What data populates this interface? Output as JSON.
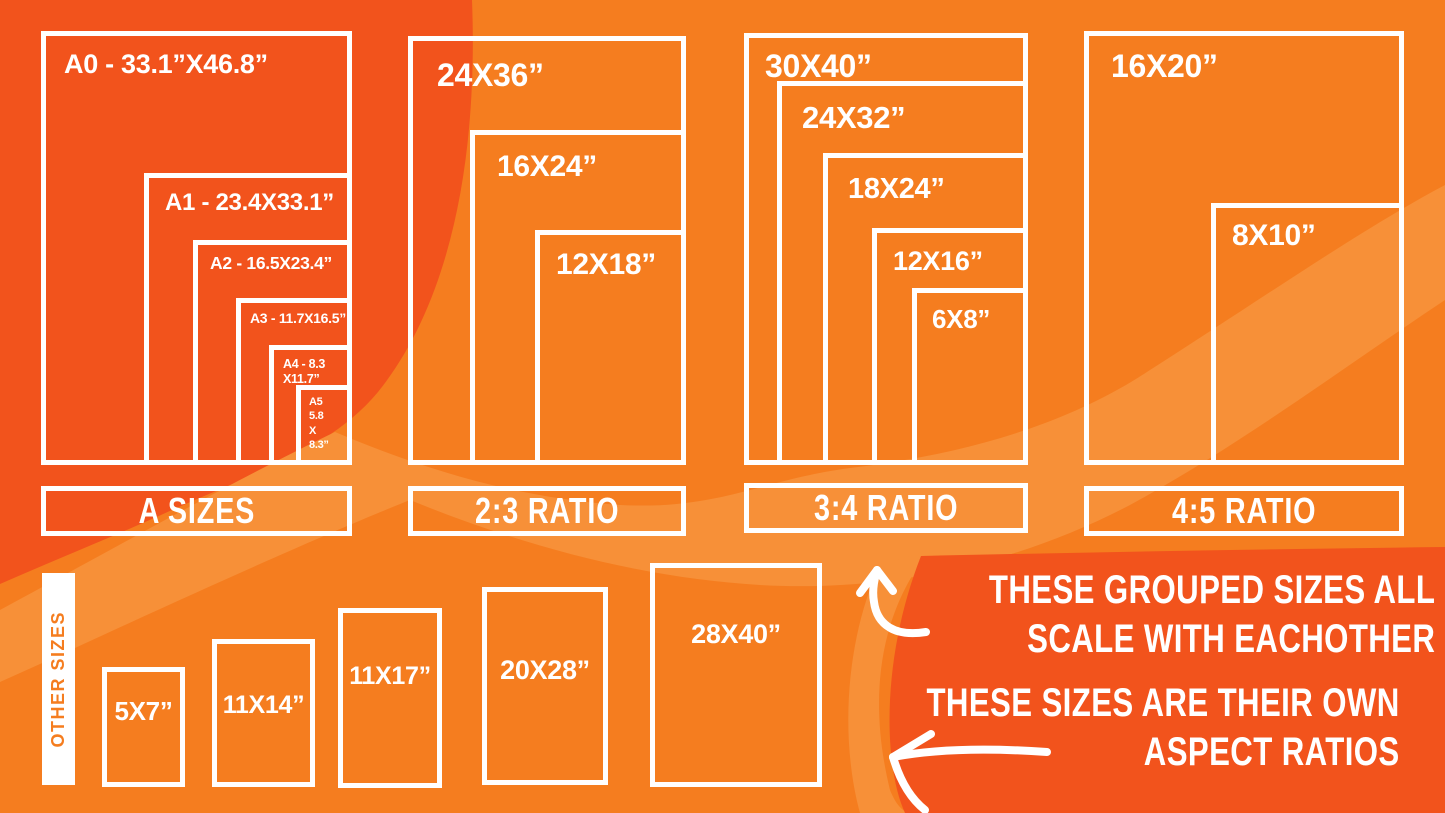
{
  "palette": {
    "background_dark": "#f2531c",
    "background_medium": "#f57d1f",
    "background_light": "#f79038",
    "box_border": "#ffffff",
    "label_text": "#ffffff",
    "other_bar_text": "#f57d1f"
  },
  "groups": [
    {
      "label": "A SIZES",
      "sizes": [
        {
          "label": "A0 - 33.1”X46.8”"
        },
        {
          "label": "A1 - 23.4X33.1”"
        },
        {
          "label": "A2 - 16.5X23.4”"
        },
        {
          "label": "A3 - 11.7X16.5”"
        },
        {
          "line1": "A4 - 8.3",
          "line2": "X11.7”"
        },
        {
          "line1": "A5",
          "line2": "5.8",
          "line3": "X",
          "line4": "8.3”"
        }
      ]
    },
    {
      "label": "2:3 RATIO",
      "sizes": [
        {
          "label": "24X36”"
        },
        {
          "label": "16X24”"
        },
        {
          "label": "12X18”"
        }
      ]
    },
    {
      "label": "3:4 RATIO",
      "sizes": [
        {
          "label": "30X40”"
        },
        {
          "label": "24X32”"
        },
        {
          "label": "18X24”"
        },
        {
          "label": "12X16”"
        },
        {
          "label": "6X8”"
        }
      ]
    },
    {
      "label": "4:5 RATIO",
      "sizes": [
        {
          "label": "16X20”"
        },
        {
          "label": "8X10”"
        }
      ]
    }
  ],
  "other_sizes": {
    "label": "OTHER SIZES",
    "sizes": [
      {
        "label": "5X7”"
      },
      {
        "label": "11X14”"
      },
      {
        "label": "11X17”"
      },
      {
        "label": "20X28”"
      },
      {
        "label": "28X40”"
      }
    ]
  },
  "annotations": {
    "grouped_note": {
      "line1": "THESE GROUPED SIZES ALL",
      "line2": "SCALE WITH EACHOTHER"
    },
    "own_note": {
      "line1": "THESE SIZES ARE THEIR OWN",
      "line2": "ASPECT RATIOS"
    }
  }
}
